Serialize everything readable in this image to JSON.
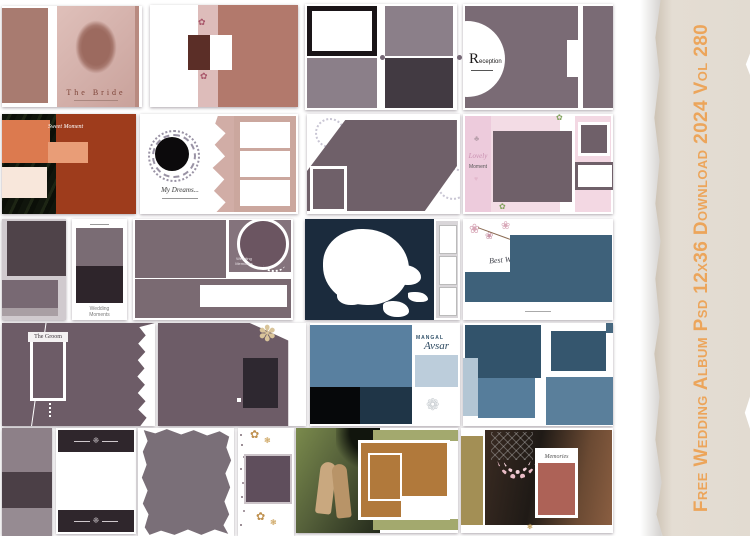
{
  "sidebar": {
    "title": "Free Wedding Album Psd 12x36 Download 2024 Vol 280",
    "text_color": "#ECA55B",
    "paper_color": "#E3DCD2"
  },
  "tiles": {
    "bride": {
      "title": "The Bride"
    },
    "reception": {
      "initial": "R",
      "rest": "eception"
    },
    "sweet_moment": {
      "title": "Sweet Moment"
    },
    "my_dreams": {
      "title": "My Dreams..."
    },
    "lovely_moment": {
      "line1": "Lovely",
      "line2": "Moment"
    },
    "wedding_moments": {
      "line1": "Wedding",
      "line2": "Moments"
    },
    "wedding_memories": {
      "line1": "Wedding",
      "line2": "Memories"
    },
    "best_wishes": {
      "title": "Best Wishes"
    },
    "groom": {
      "title": "The Groom"
    },
    "mangal_avsar": {
      "line1": "Mangal",
      "line2": "Avsar"
    },
    "memories": {
      "title": "Memories"
    }
  },
  "icons": {
    "flourish": "❈",
    "flower": "✽",
    "blossom": "❀",
    "sprig": "✿",
    "lotus": "❁",
    "heart": "♥",
    "tree": "♣",
    "ornament": "❃"
  },
  "palette": {
    "mauve": "#6F5F6B",
    "mauve_light": "#8A7E87",
    "charcoal": "#3C333C",
    "rose_brown": "#A87B70",
    "rose_light": "#D8B7B1",
    "brown_dark": "#5B2E27",
    "rust": "#9E3C1C",
    "orange": "#DC7A4F",
    "salmon": "#E99D77",
    "cream": "#F8E7DB",
    "pink": "#F2D7E2",
    "navy": "#1C2C3F",
    "steel_blue": "#5980A0",
    "blue_dark": "#32536B",
    "blue_light": "#B3C6D4",
    "olive": "#A3A96E",
    "ochre": "#B1793B",
    "gold": "#C09A52"
  }
}
